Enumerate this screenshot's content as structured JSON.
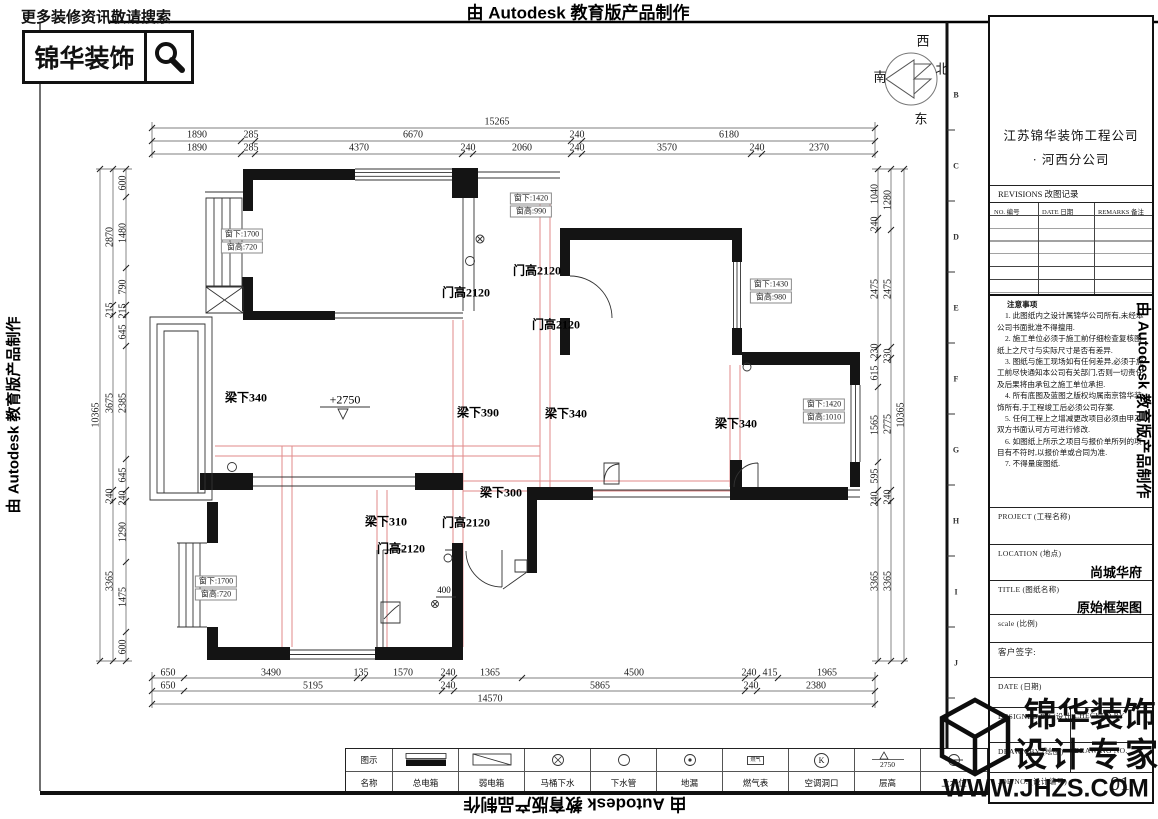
{
  "banner": {
    "autodesk": "由 Autodesk 教育版产品制作"
  },
  "promo": {
    "tagline": "更多装修资讯敬请搜索",
    "brand": "锦华装饰"
  },
  "compass": {
    "top": "西",
    "left": "南",
    "right": "北",
    "bottom": "东"
  },
  "grid_letters": [
    "B",
    "C",
    "D",
    "E",
    "F",
    "G",
    "H",
    "I",
    "J"
  ],
  "dims": {
    "top": {
      "total": "15265",
      "row2": [
        "1890",
        "285",
        "6670",
        "240",
        "6180"
      ],
      "row3": [
        "1890",
        "285",
        "4370",
        "240",
        "2060",
        "240",
        "3570",
        "240",
        "2370"
      ]
    },
    "bottom": {
      "row1": [
        "650",
        "3490",
        "135",
        "1570",
        "240",
        "1365",
        "4500",
        "240",
        "415",
        "1965"
      ],
      "row2": [
        "650",
        "5195",
        "240",
        "5865",
        "240",
        "2380"
      ],
      "total": "14570"
    },
    "left": {
      "total": "10365",
      "mid": [
        "2870",
        "215",
        "3675",
        "240",
        "3365"
      ],
      "inner": [
        "600",
        "1480",
        "790",
        "215",
        "645",
        "2385",
        "645",
        "240",
        "1290",
        "1475",
        "600"
      ]
    },
    "right": {
      "total": "10365",
      "mid": [
        "1280",
        "2475",
        "230",
        "2775",
        "240",
        "3365"
      ],
      "inner": [
        "1040",
        "240",
        "2475",
        "230",
        "615",
        "1565",
        "595",
        "240",
        "3365"
      ]
    }
  },
  "plan": {
    "door_height": "门高2120",
    "beams": [
      "梁下340",
      "梁下390",
      "梁下340",
      "梁下340",
      "梁下300",
      "梁下310"
    ],
    "level_mark": "+2750",
    "drain_dim": "400",
    "windows": [
      {
        "line1": "窗下:1700",
        "line2": "窗高:720"
      },
      {
        "line1": "窗下:1420",
        "line2": "窗高:990"
      },
      {
        "line1": "窗下:1430",
        "line2": "窗高:980"
      },
      {
        "line1": "窗下:1420",
        "line2": "窗高:1010"
      },
      {
        "line1": "窗下:1700",
        "line2": "窗高:720"
      }
    ]
  },
  "title_block": {
    "company": "江苏锦华装饰工程公司",
    "branch": "·     河西分公司",
    "revisions_header": "REVISIONS 改图记录",
    "rev_no": "NO. 编号",
    "rev_date": "DATE 日期",
    "rev_remarks": "REMARKS 备注",
    "notes_title": "注意事项",
    "notes": [
      "1. 此图纸内之设计属锦华公司所有,未经本公司书面批准不得擅用.",
      "2. 施工单位必须于施工前仔细检查复核图纸上之尺寸与实际尺寸是否有差异.",
      "3. 图纸与施工现场如有任何差异,必须于施工前尽快通知本公司有关部门,否则一切责任及后果将由承包之施工单位承担.",
      "4. 所有底图及蓝图之版权均属南京锦华装饰所有,于工程竣工后必须公司存案.",
      "5. 任何工程上之增减更改项目必须由甲乙双方书面认可方可进行修改.",
      "6. 如图纸上所示之项目与报价单所列的项目有不符时,以报价单或合同为准.",
      "7. 不得量度图纸."
    ],
    "project_label": "PROJECT (工程名称)",
    "location_label": "LOCATION (地点)",
    "location_value": "尚城华府",
    "title_label": "TITLE (图纸名称)",
    "title_value": "原始框架图",
    "scale_label": "scale   (比例)",
    "client_sign_label": "客户签字:",
    "date_label": "DATE (日期)",
    "designed_by": "DESIGNED BY (设计)",
    "checked_by": "CHECKED BY",
    "drawn_by": "DRAWN BY (绘图)",
    "drawing_no_label": "DRAWING NO.",
    "job_no_label": "JOB NO. (设计编号)",
    "drawing_number": "01"
  },
  "watermark": {
    "line1": "锦华装饰",
    "line2": "设计专家",
    "website": "WWW.JHZS.COM"
  },
  "legend": {
    "symbol_row": "图示",
    "name_row": "名称",
    "items": [
      "总电箱",
      "弱电箱",
      "马桶下水",
      "下水管",
      "地漏",
      "燃气表",
      "空调洞口",
      "层高",
      "上水位"
    ],
    "gas_text": "燃气",
    "ac_letter": "K",
    "floor_height": "2750"
  }
}
